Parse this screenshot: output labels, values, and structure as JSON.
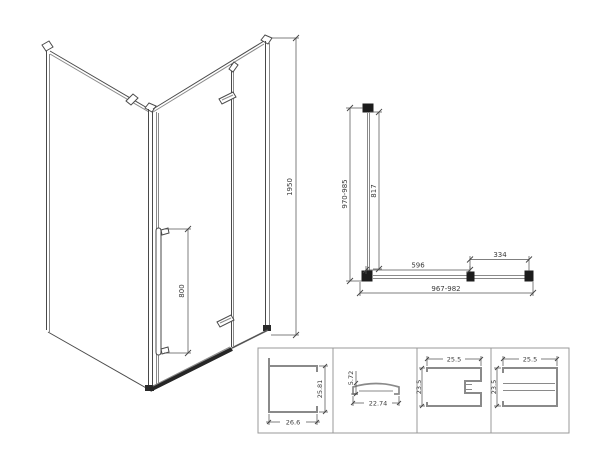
{
  "iso_view": {
    "overall_height": "1950",
    "handle_length": "800"
  },
  "plan_view": {
    "depth_range": "970-985",
    "side_glass_depth": "817",
    "door_glass_width": "596",
    "fixed_glass_width": "334",
    "width_range": "967-982"
  },
  "profile_details": [
    {
      "width": "26.6",
      "height": "25.81"
    },
    {
      "width": "22.74",
      "height": "5.72"
    },
    {
      "width": "25.5",
      "height": "23.5"
    },
    {
      "width": "25.5",
      "height": "23.5"
    }
  ]
}
